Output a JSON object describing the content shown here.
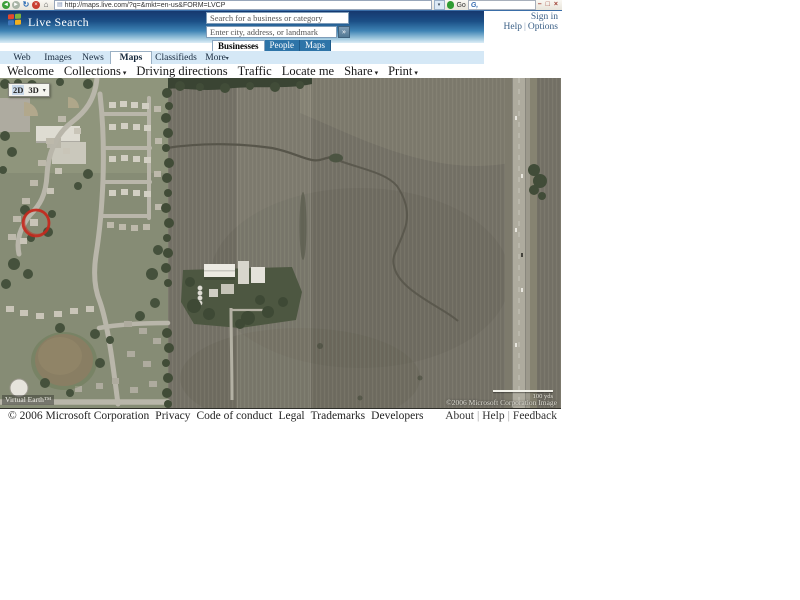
{
  "browser": {
    "url": "http://maps.live.com/?q=&mkt=en-us&FORM=LVCP",
    "go_label": "Go",
    "addon_search_logo": "G,"
  },
  "icons": {
    "back_arrow": "◄",
    "forward_arrow": "►",
    "refresh": "↻",
    "stop": "×",
    "home": "⌂",
    "page": "▤",
    "url_dropdown": "▾",
    "minimize": "–",
    "restore": "□",
    "close": "×",
    "search_go_arrow": "»",
    "dropdown_arrow": "▾"
  },
  "header": {
    "brand": "Live Search",
    "business_placeholder": "Search for a business or category",
    "location_placeholder": "Enter city, address, or landmark",
    "sign_in": "Sign in",
    "help": "Help",
    "options": "Options",
    "scope_tabs": {
      "businesses": "Businesses",
      "people": "People",
      "maps": "Maps"
    }
  },
  "tabs": {
    "web": "Web",
    "images": "Images",
    "news": "News",
    "maps": "Maps",
    "classifieds": "Classifieds",
    "more": "More"
  },
  "nav": {
    "welcome": "Welcome",
    "collections": "Collections",
    "driving_directions": "Driving directions",
    "traffic": "Traffic",
    "locate_me": "Locate me",
    "share": "Share",
    "print": "Print"
  },
  "map": {
    "view_2d": "2D",
    "view_3d": "3D",
    "watermark": "Virtual Earth™",
    "scale_label": "100 yds",
    "attribution": "©2006 Microsoft Corporation  Image",
    "annotation_color": "#c42a1e",
    "accent_blue": "#2e74a8"
  },
  "footer": {
    "copyright": "© 2006 Microsoft Corporation",
    "privacy": "Privacy",
    "code_of_conduct": "Code of conduct",
    "legal": "Legal",
    "trademarks": "Trademarks",
    "developers": "Developers",
    "about": "About",
    "help": "Help",
    "feedback": "Feedback"
  }
}
